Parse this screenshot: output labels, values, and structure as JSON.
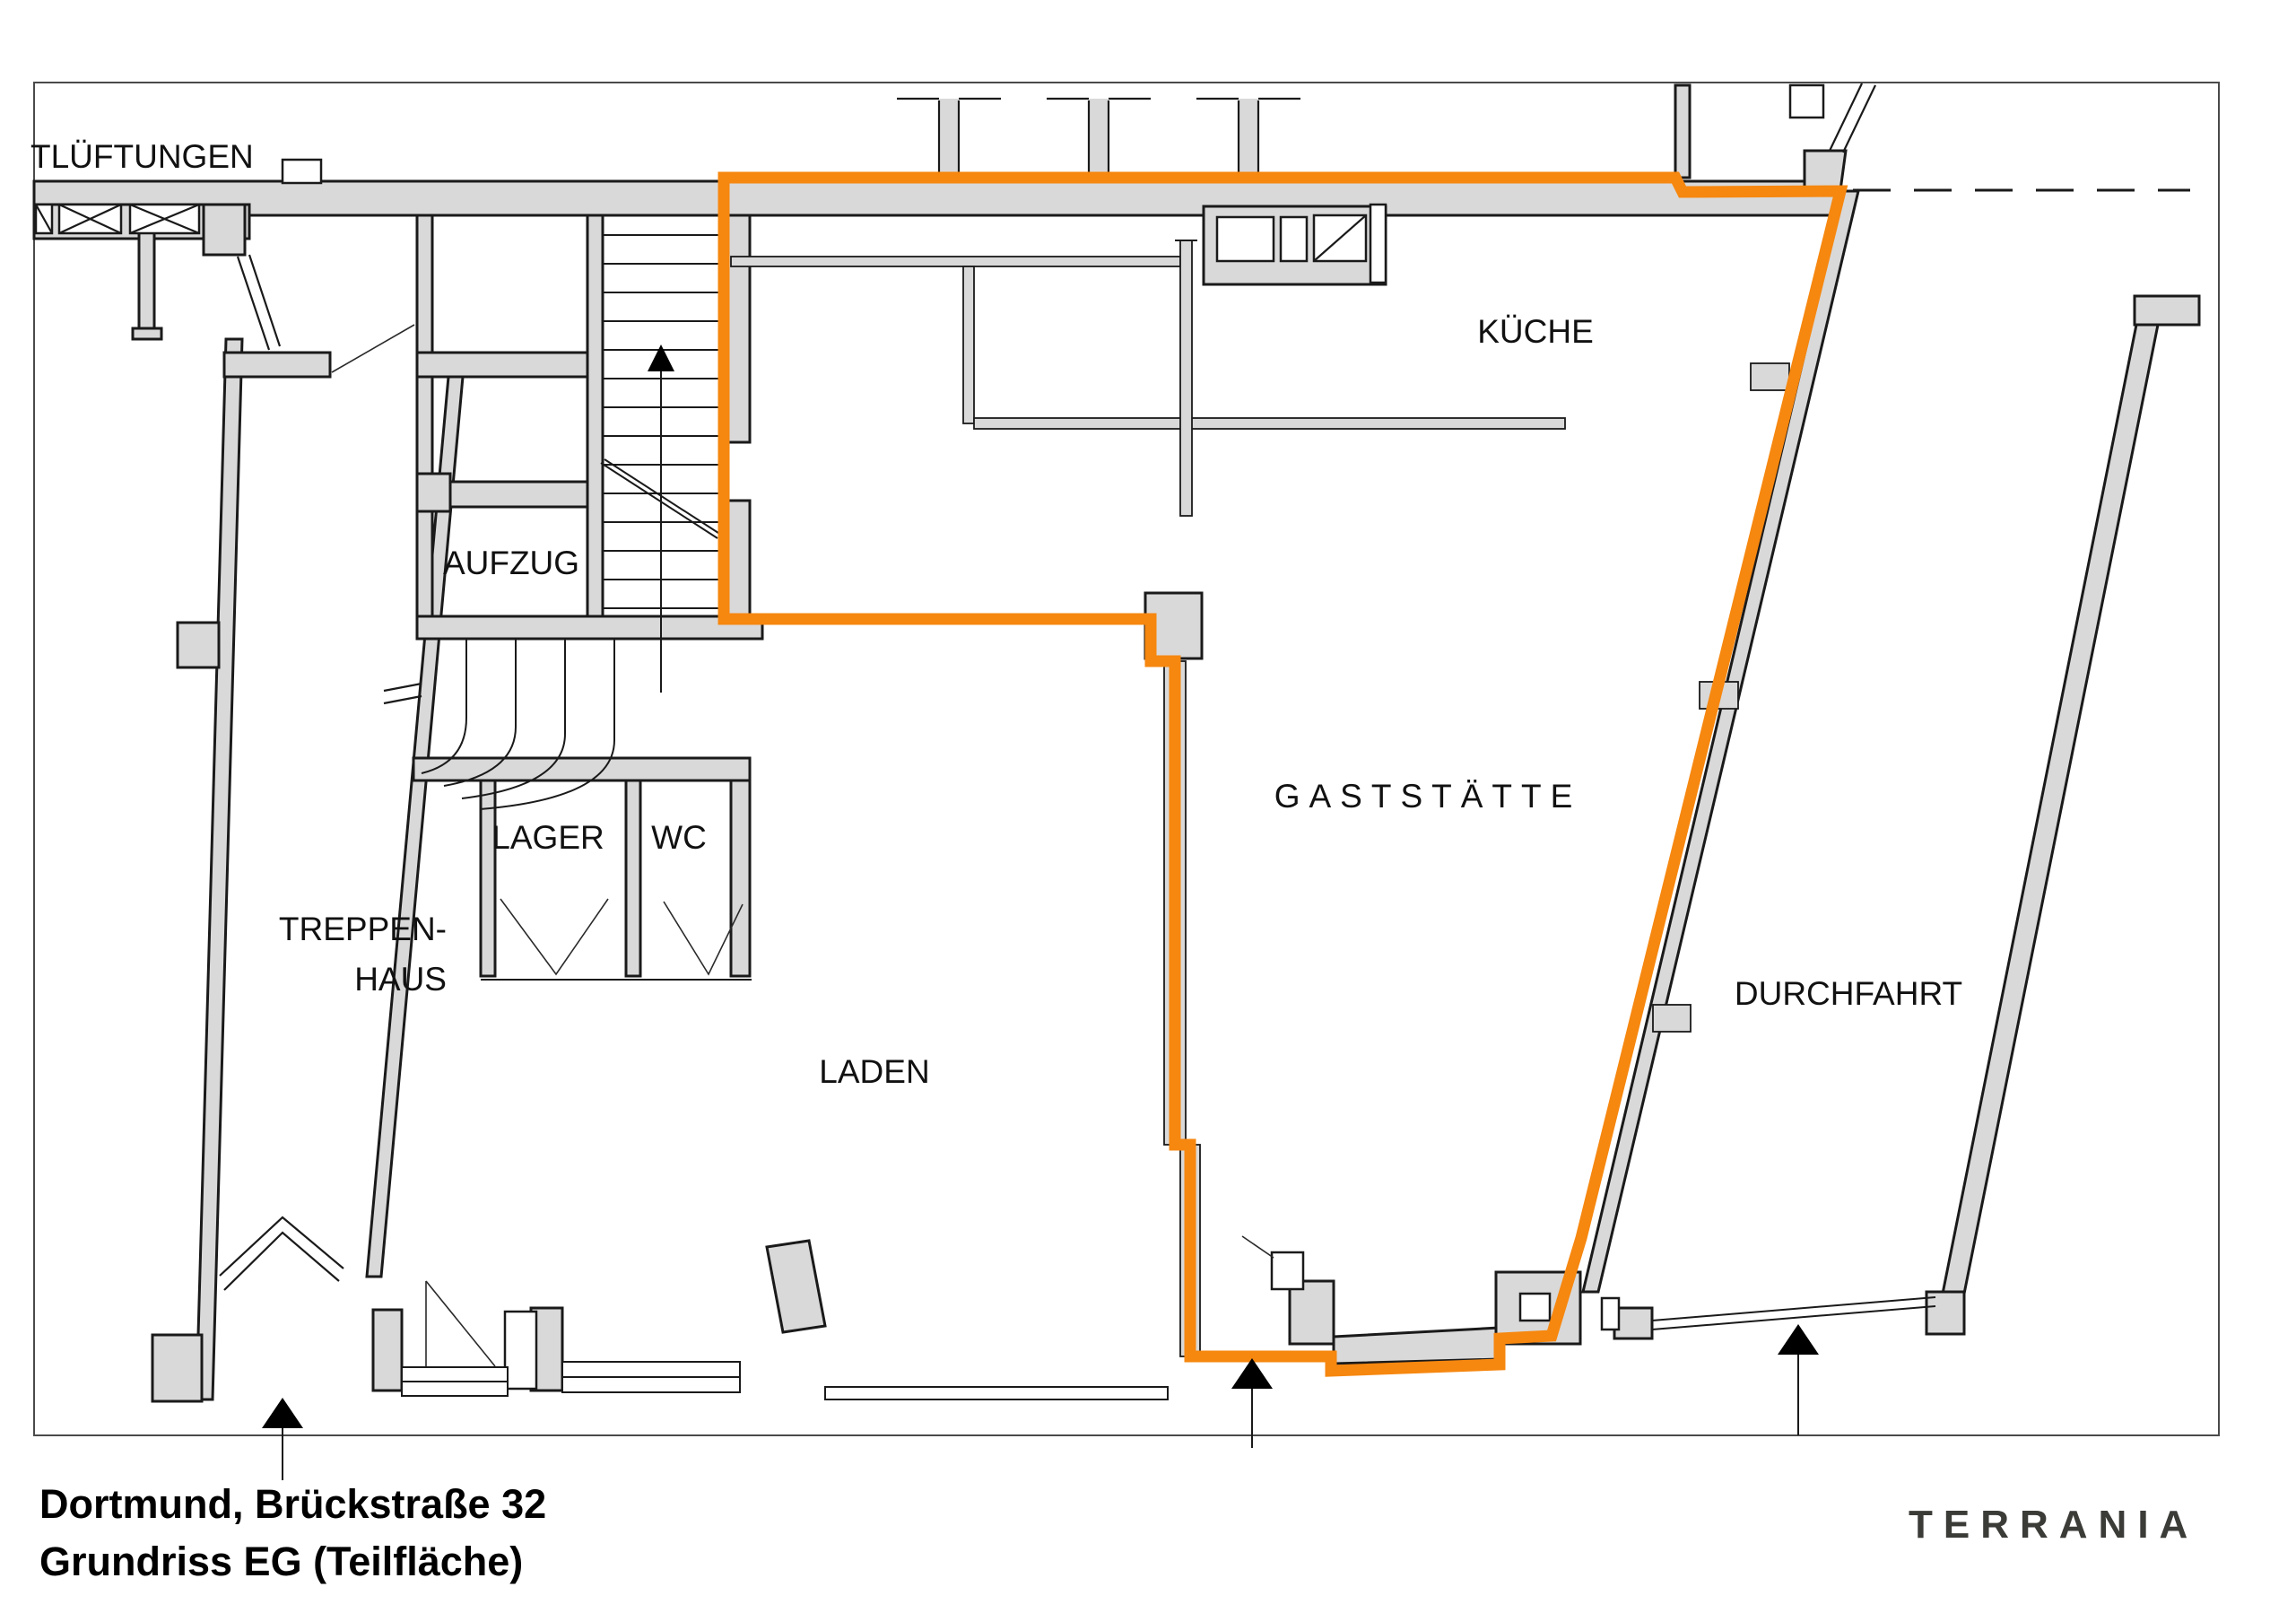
{
  "plan": {
    "highlight_color": "#F6870F",
    "wall_color": "#D9D9D9",
    "line_color": "#1A1A1A",
    "logo_color": "#3B3B38"
  },
  "labels": {
    "ventilation": "TLÜFTUNGEN",
    "elevator": "AUFZUG",
    "storage": "LAGER",
    "wc": "WC",
    "stairwell_line1": "TREPPEN-",
    "stairwell_line2": "HAUS",
    "shop": "LADEN",
    "restaurant": "GASTSTÄTTE",
    "kitchen": "KÜCHE",
    "passage": "DURCHFAHRT"
  },
  "title": {
    "line1": "Dortmund, Brückstraße 32",
    "line2": "Grundriss EG (Teilfläche)"
  },
  "logo": "TERRANIA"
}
